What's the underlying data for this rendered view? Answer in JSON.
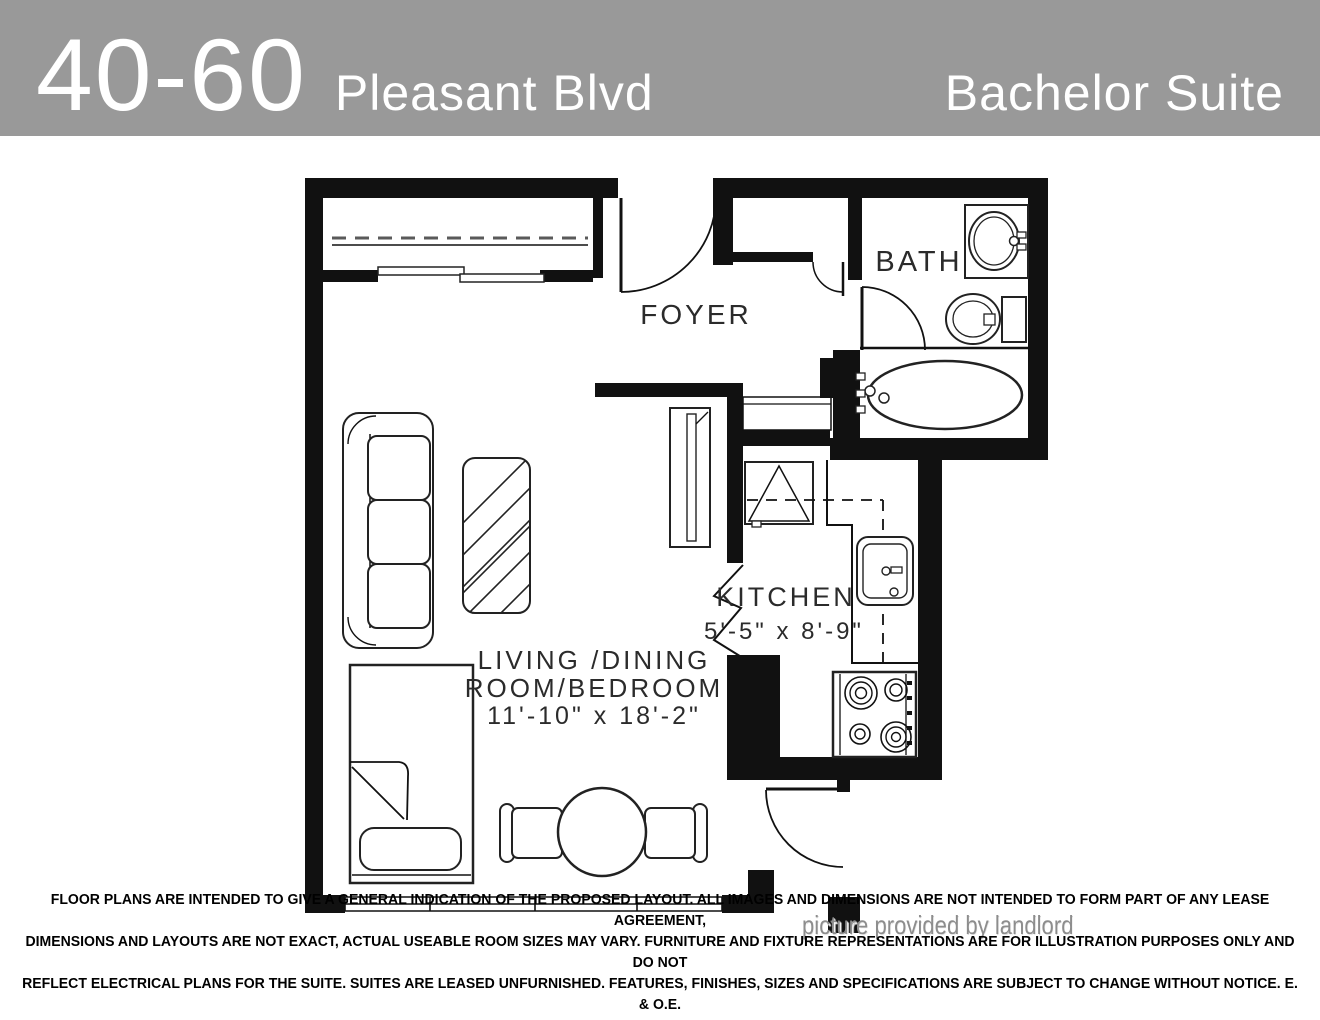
{
  "header": {
    "building_number": "40-60",
    "street_name": "Pleasant Blvd",
    "suite_type": "Bachelor Suite"
  },
  "rooms": {
    "foyer": {
      "label": "FOYER"
    },
    "bath": {
      "label": "BATH"
    },
    "kitchen": {
      "label": "KITCHEN",
      "dimensions": "5'-5\" x 8'-9\""
    },
    "living": {
      "label_line1": "LIVING /DINING",
      "label_line2": "ROOM/BEDROOM",
      "dimensions": "11'-10\" x 18'-2\""
    }
  },
  "credit": "picture provided by landlord",
  "disclaimer": {
    "line1": "FLOOR PLANS ARE INTENDED TO GIVE A GENERAL INDICATION OF THE PROPOSED LAYOUT. ALL IMAGES AND DIMENSIONS ARE NOT INTENDED TO FORM PART OF ANY LEASE AGREEMENT,",
    "line2": "DIMENSIONS AND LAYOUTS ARE NOT EXACT, ACTUAL USEABLE ROOM SIZES MAY VARY. FURNITURE AND FIXTURE REPRESENTATIONS ARE FOR ILLUSTRATION PURPOSES ONLY AND DO NOT",
    "line3": "REFLECT ELECTRICAL PLANS FOR THE SUITE. SUITES ARE LEASED UNFURNISHED. FEATURES, FINISHES, SIZES AND SPECIFICATIONS ARE SUBJECT TO CHANGE WITHOUT NOTICE. E. & O.E."
  },
  "colors": {
    "header_background": "#999999",
    "header_text": "#ffffff",
    "plan_line": "#111111",
    "credit_text": "#8d8d8d"
  }
}
